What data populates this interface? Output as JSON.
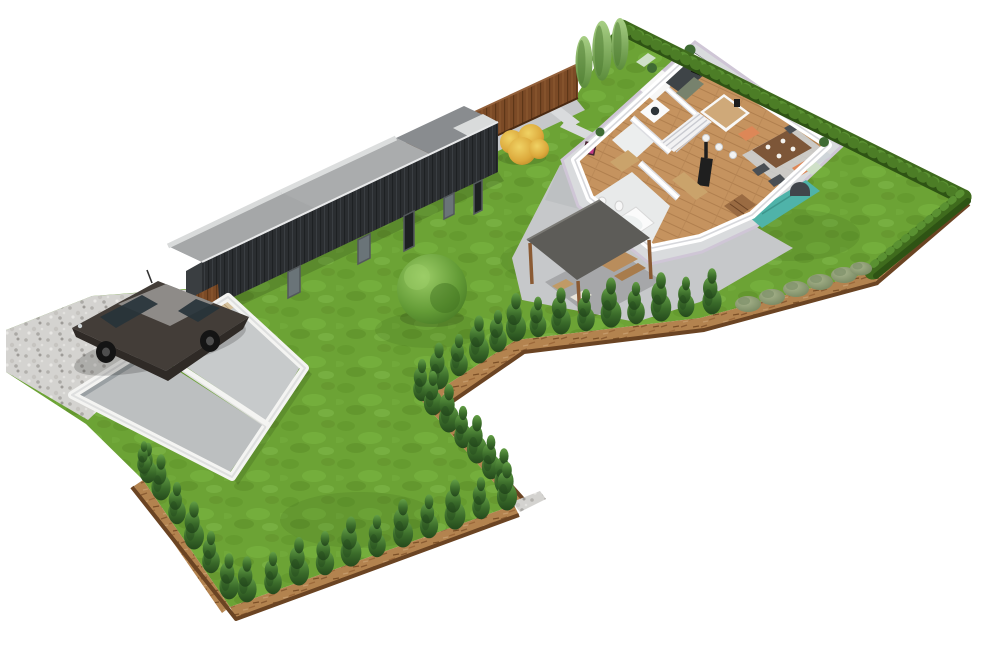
{
  "meta": {
    "kind": "3d-isometric-site-plan",
    "description": "Aerial isometric 3D rendering of a residential plot: cutaway single-storey house floor plan, long dark outbuilding, open-top garage with parked car on gravel drive, pergola patio, lawns bordered by hedges, conifer rows, mulch strips and a wooden fence on a white background"
  },
  "colors": {
    "background": "#ffffff",
    "lawn": "#6ca335",
    "lawnDark": "#578a25",
    "lawnLight": "#83ba4a",
    "hedge": "#3f6b1d",
    "hedgeLight": "#5a9132",
    "hedgeDark": "#2e5314",
    "conifer": "#2f5f25",
    "coniferLight": "#5a9340",
    "cypress": "#86b45e",
    "shrub": "#93a37b",
    "mulch": "#b3834f",
    "mulchDark": "#8a5c32",
    "soilRim": "#6b4423",
    "gravel": "#d4d3d0",
    "concrete": "#c6c8ca",
    "concreteLight": "#d9dbdd",
    "fence": "#7b4a26",
    "fenceDark": "#5e3718",
    "shedWall": "#2b2e31",
    "shedRoof": "#898c8f",
    "shedFloor": "#a5a7a8",
    "shedInner": "#d9dbdb",
    "garageWall": "#f4f4f2",
    "garageInnerGray": "#9aa0a3",
    "garageFloor": "#bcbfc0",
    "slatWood": "#d5c19c",
    "carBody": "#433d38",
    "carRoof": "#8e8b88",
    "carGlass": "#27333a",
    "pergolaRoof": "#5d5c58",
    "wood": "#8a5a33",
    "houseWall": "#ffffff",
    "houseShade": "#dddee2",
    "floorWood": "#c5935f",
    "tile": "#e8eaea",
    "sofa": "#4fb3a9",
    "chairOrange": "#dd8757",
    "tableWood": "#7d5638",
    "rug": "#ccd3d8",
    "art": "#c03a84",
    "plant": "#3f6b33",
    "stove": "#1f1f1f",
    "skirt": "#cfc6d6",
    "treeYellow": "#d9a83a",
    "treeYellowLight": "#eac34f",
    "treeRound": "#5d9434"
  },
  "elements": {
    "boundaries": [
      "north-wooden-fence",
      "northeast-hedge",
      "east-hedge",
      "mulch-borders",
      "conifer-rows",
      "grey-shrub-row"
    ],
    "vegetation": [
      "round-deciduous-tree",
      "yellow-autumn-bush",
      "three-tall-cypresses",
      "lawns"
    ],
    "structures": [
      "cutaway-house",
      "dark-outbuilding",
      "open-top-garage",
      "pergola"
    ],
    "house_rooms": [
      "kitchen",
      "dining-area",
      "living-area",
      "hallway",
      "bathroom",
      "laundry",
      "staircase"
    ],
    "house_furniture": [
      "kitchen-counter",
      "oven",
      "island-with-stools",
      "washing-machine",
      "dining-table",
      "orange-armchairs",
      "dark-chairs",
      "teal-sofa",
      "bookshelf",
      "wood-stove",
      "bathtub",
      "wall-art",
      "indoor-plants",
      "area-rug"
    ],
    "exterior_objects": [
      "parked-car",
      "gravel-driveway",
      "concrete-patio",
      "garden-furniture",
      "wooden-gate"
    ]
  }
}
